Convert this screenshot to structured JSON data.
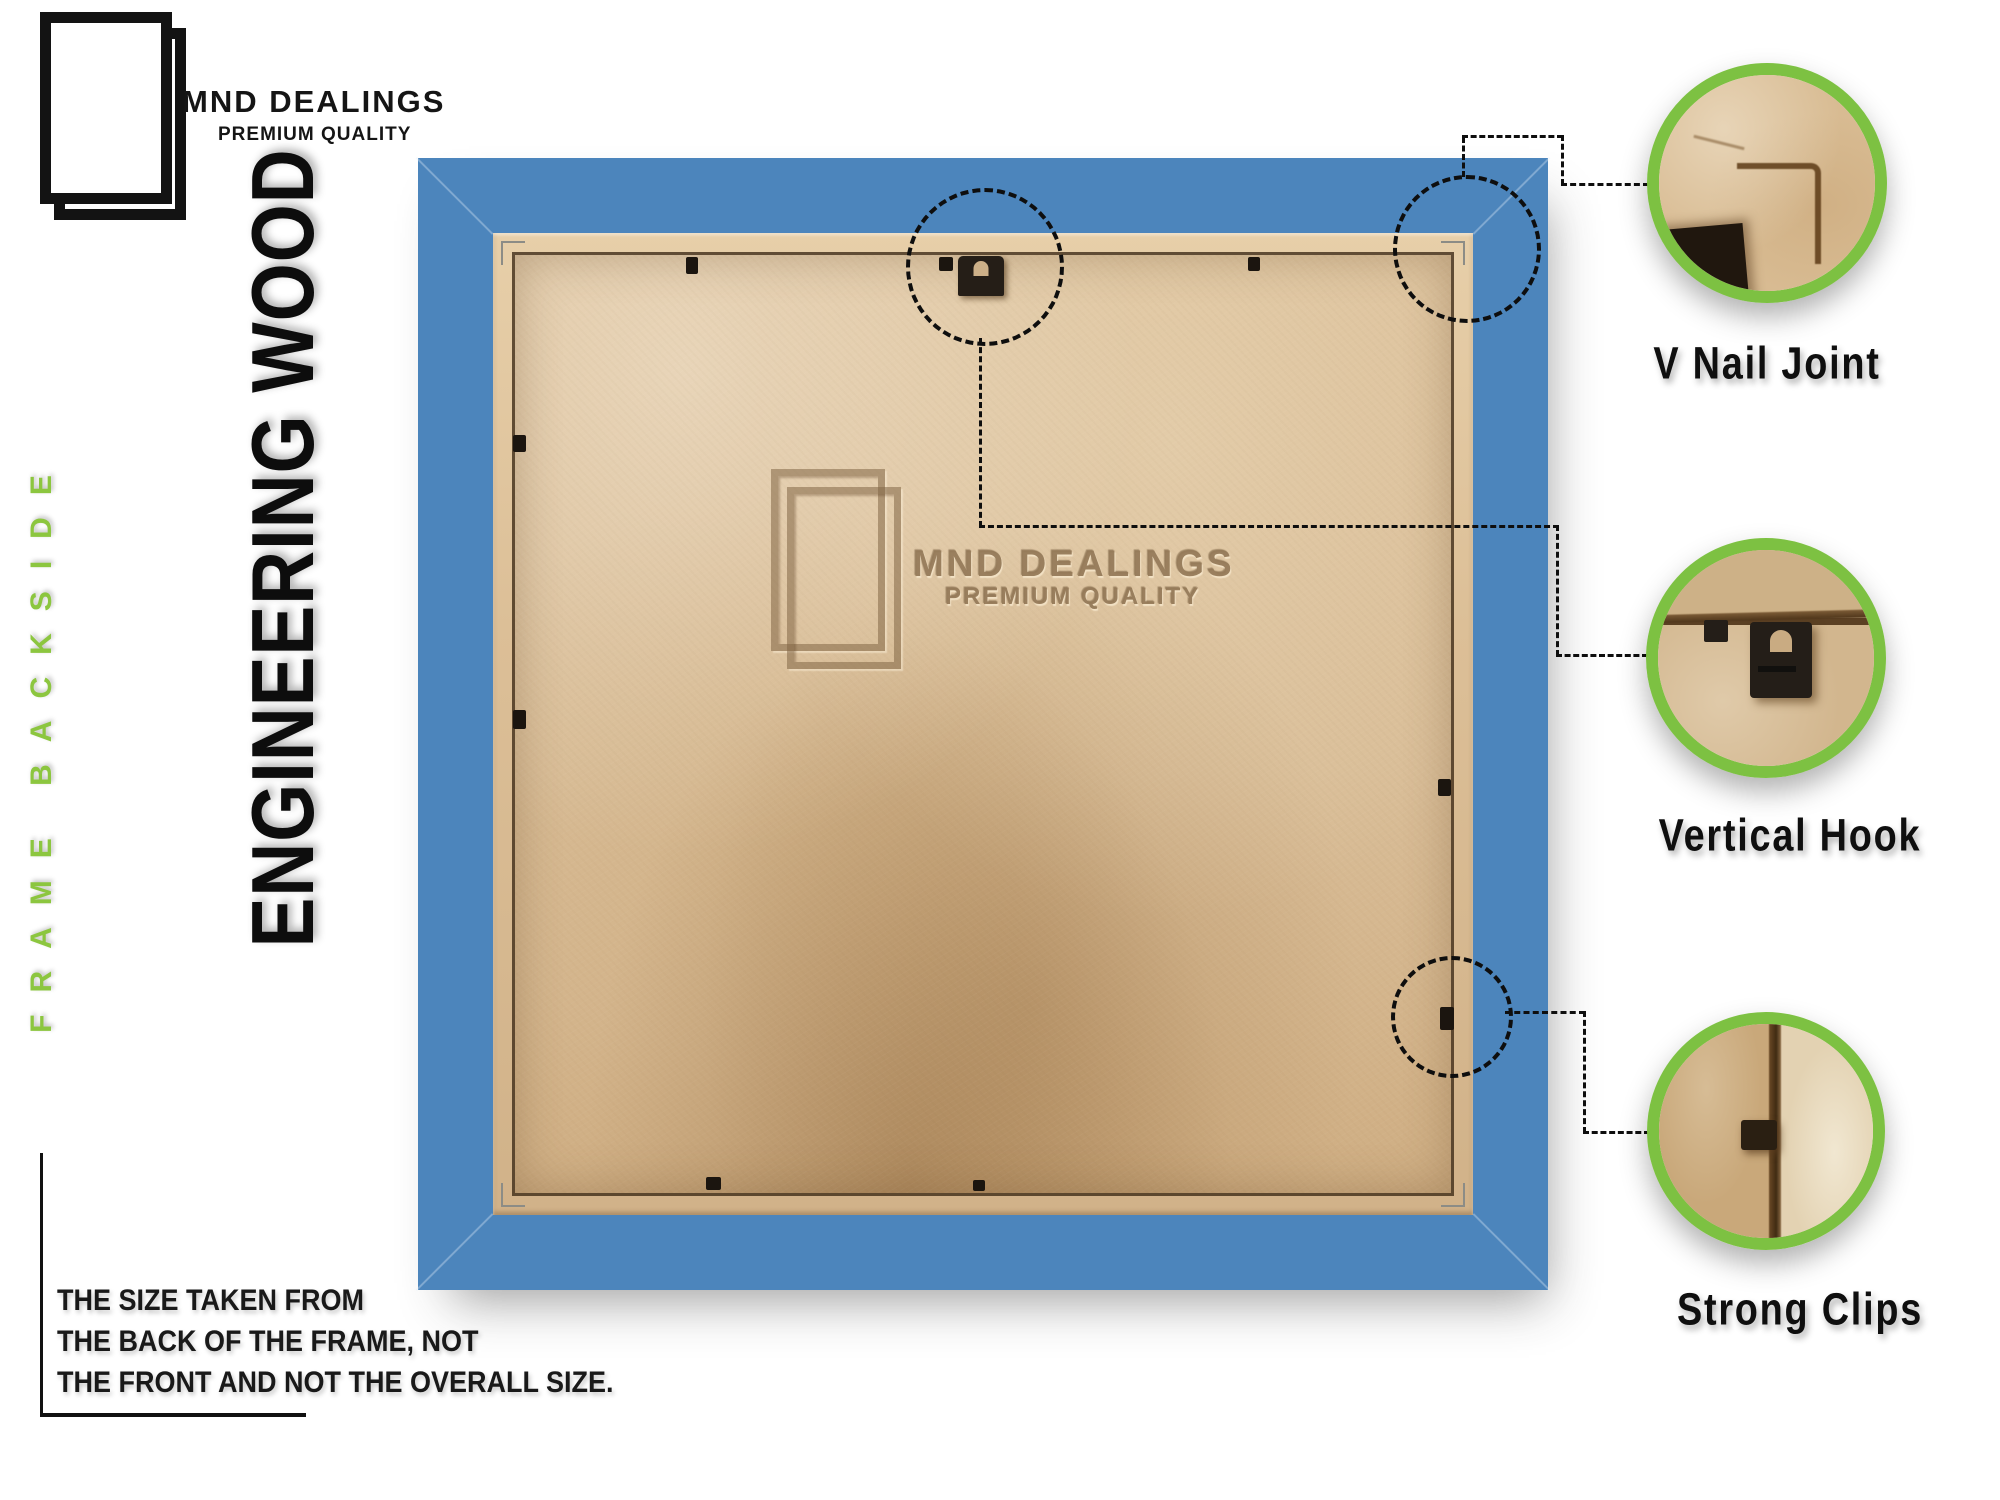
{
  "brand": {
    "name": "MND DEALINGS",
    "tagline": "PREMIUM QUALITY"
  },
  "side_label": "FRAME BACKSIDE",
  "material_label": "ENGINEERING WOOD",
  "watermark": {
    "name": "MND DEALINGS",
    "tagline": "PREMIUM QUALITY"
  },
  "note": {
    "lines": [
      "THE SIZE TAKEN FROM",
      "THE BACK OF THE FRAME, NOT",
      "THE FRONT AND NOT THE OVERALL SIZE."
    ]
  },
  "callouts": [
    {
      "id": "v-nail-joint",
      "label": "V Nail Joint"
    },
    {
      "id": "vertical-hook",
      "label": "Vertical Hook"
    },
    {
      "id": "strong-clips",
      "label": "Strong Clips"
    }
  ],
  "colors": {
    "frame_blue": "#4c85bc",
    "callout_green": "#7dc142",
    "side_label_green": "#8cc63f",
    "panel_tan": "#d9bd97",
    "hardware_dark": "#241e18"
  }
}
